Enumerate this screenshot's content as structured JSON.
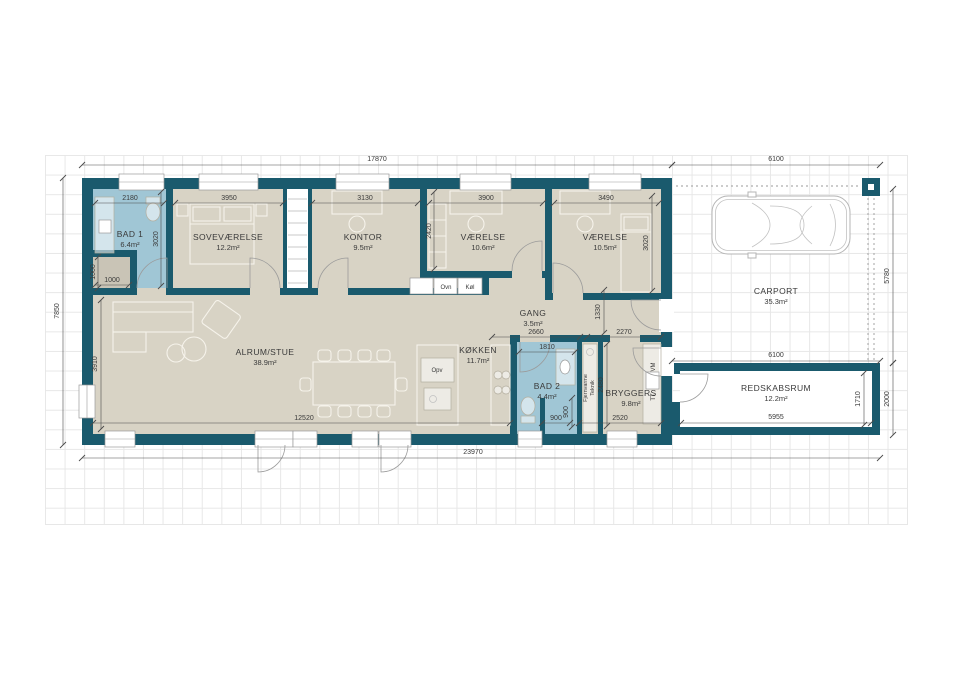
{
  "rooms": {
    "bad1": {
      "name": "BAD 1",
      "area": "6.4m²"
    },
    "sovevaerelse": {
      "name": "SOVEVÆRELSE",
      "area": "12.2m²"
    },
    "kontor": {
      "name": "KONTOR",
      "area": "9.5m²"
    },
    "vaerelse1": {
      "name": "VÆRELSE",
      "area": "10.6m²"
    },
    "vaerelse2": {
      "name": "VÆRELSE",
      "area": "10.5m²"
    },
    "gang": {
      "name": "GANG",
      "area": "3.5m²"
    },
    "alrum": {
      "name": "ALRUM/STUE",
      "area": "38.9m²"
    },
    "kokken": {
      "name": "KØKKEN",
      "area": "11.7m²"
    },
    "bad2": {
      "name": "BAD 2",
      "area": "4.4m²"
    },
    "bryggers": {
      "name": "BRYGGERS",
      "area": "9.8m²"
    },
    "carport": {
      "name": "CARPORT",
      "area": "35.3m²"
    },
    "redskabsrum": {
      "name": "REDSKABSRUM",
      "area": "12.2m²"
    }
  },
  "appliances": {
    "ovn": "Ovn",
    "koel": "Køl",
    "opv": "Opv",
    "vm": "VM",
    "tt": "TT",
    "fjernvarme": "Fjernvarme",
    "teknik": "Teknik"
  },
  "dimensions": {
    "d17870": "17870",
    "d6100_carport": "6100",
    "d7850": "7850",
    "d5780": "5780",
    "d2000": "2000",
    "d23970": "23970",
    "d2180": "2180",
    "d3950": "3950",
    "d3130": "3130",
    "d3900": "3900",
    "d3490": "3490",
    "d3020_bad1": "3020",
    "d1000_v": "1000",
    "d1000_h": "1000",
    "d3910": "3910",
    "d2420": "2420",
    "d3020_v2": "3020",
    "d1330": "1330",
    "d2660": "2660",
    "d2270": "2270",
    "d1810": "1810",
    "d2480": "2480",
    "d2520": "2520",
    "d900_v": "900",
    "d900_h": "900",
    "d12520": "12520",
    "d6100_shed": "6100",
    "d5955": "5955",
    "d1710": "1710"
  },
  "colors": {
    "wall": "#1a5a6d",
    "floor": "#d8d3c5",
    "bath": "#a0c6d5",
    "niche": "#c9c4b6",
    "furn": "#f6f3eb",
    "grid": "#e7e7e7"
  }
}
